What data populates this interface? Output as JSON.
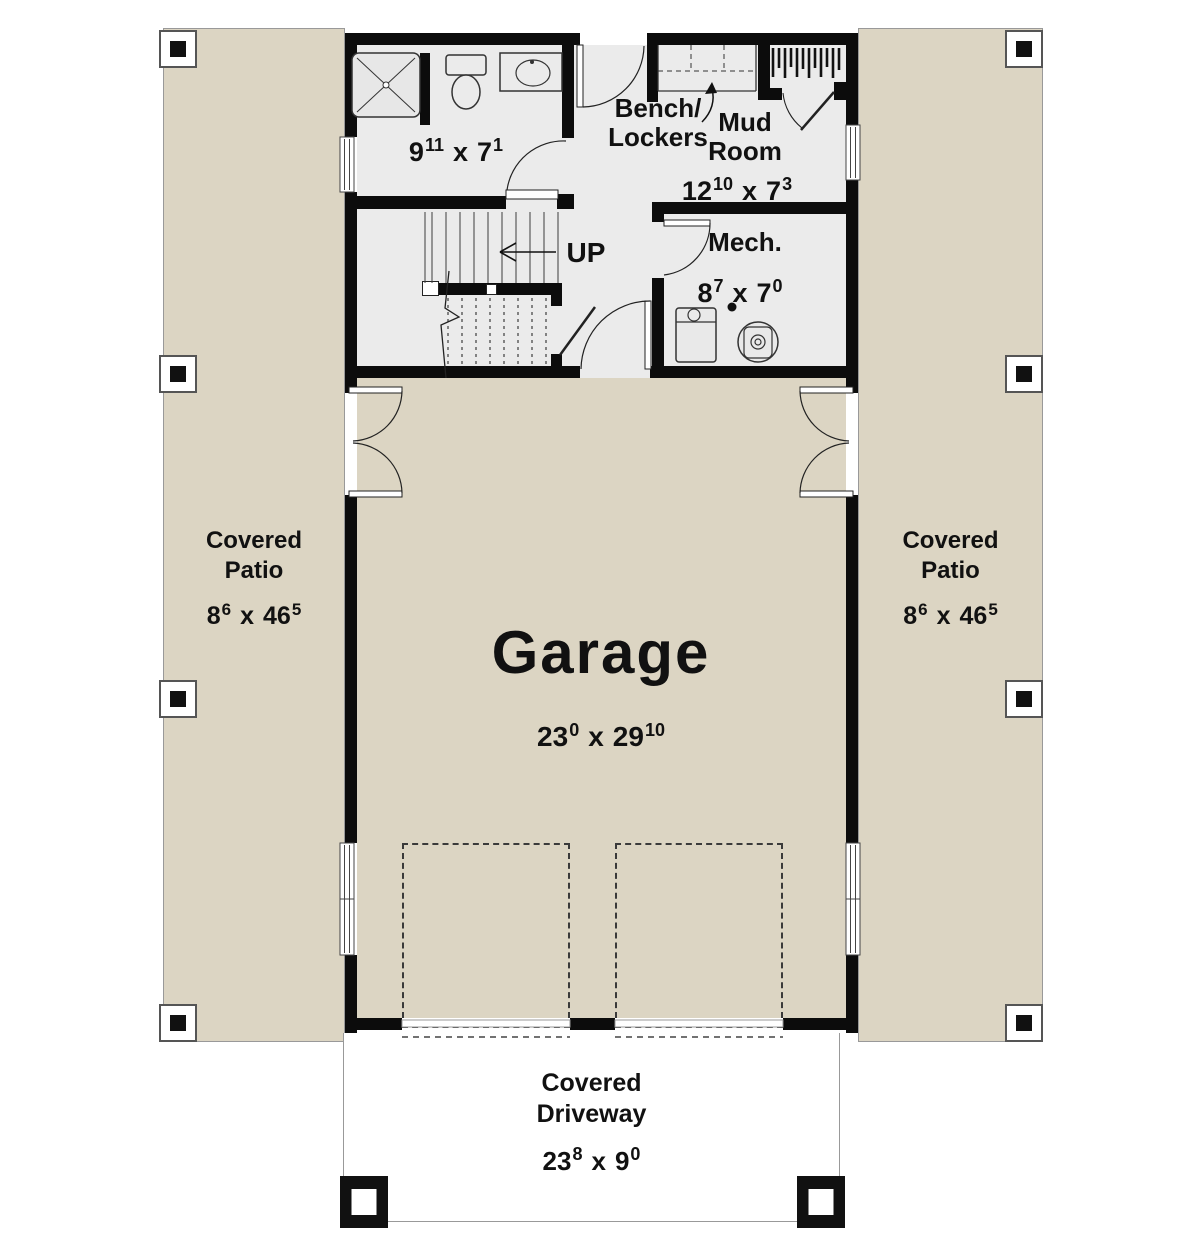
{
  "labels": {
    "up": "UP",
    "x_sep": "x"
  },
  "rooms": {
    "bathroom": {
      "dim": {
        "a": "9",
        "a_in": "11",
        "b": "7",
        "b_in": "1"
      }
    },
    "bench_lockers": {
      "line1": "Bench/",
      "line2": "Lockers"
    },
    "mud_room": {
      "line1": "Mud",
      "line2": "Room",
      "dim": {
        "a": "12",
        "a_in": "10",
        "b": "7",
        "b_in": "3"
      }
    },
    "mech_room": {
      "name": "Mech.",
      "dim": {
        "a": "8",
        "a_in": "7",
        "b": "7",
        "b_in": "0"
      }
    },
    "garage": {
      "name": "Garage",
      "dim": {
        "a": "23",
        "a_in": "0",
        "b": "29",
        "b_in": "10"
      }
    },
    "covered_patio_left": {
      "line1": "Covered",
      "line2": "Patio",
      "dim": {
        "a": "8",
        "a_in": "6",
        "b": "46",
        "b_in": "5"
      }
    },
    "covered_patio_right": {
      "line1": "Covered",
      "line2": "Patio",
      "dim": {
        "a": "8",
        "a_in": "6",
        "b": "46",
        "b_in": "5"
      }
    },
    "covered_driveway": {
      "line1": "Covered",
      "line2": "Driveway",
      "dim": {
        "a": "23",
        "a_in": "8",
        "b": "9",
        "b_in": "0"
      }
    }
  },
  "colors": {
    "wall": "#0c0c0c",
    "interior_floor": "#ebebeb",
    "exterior_surface": "#dcd5c3",
    "background": "#ffffff",
    "text": "#111111"
  }
}
